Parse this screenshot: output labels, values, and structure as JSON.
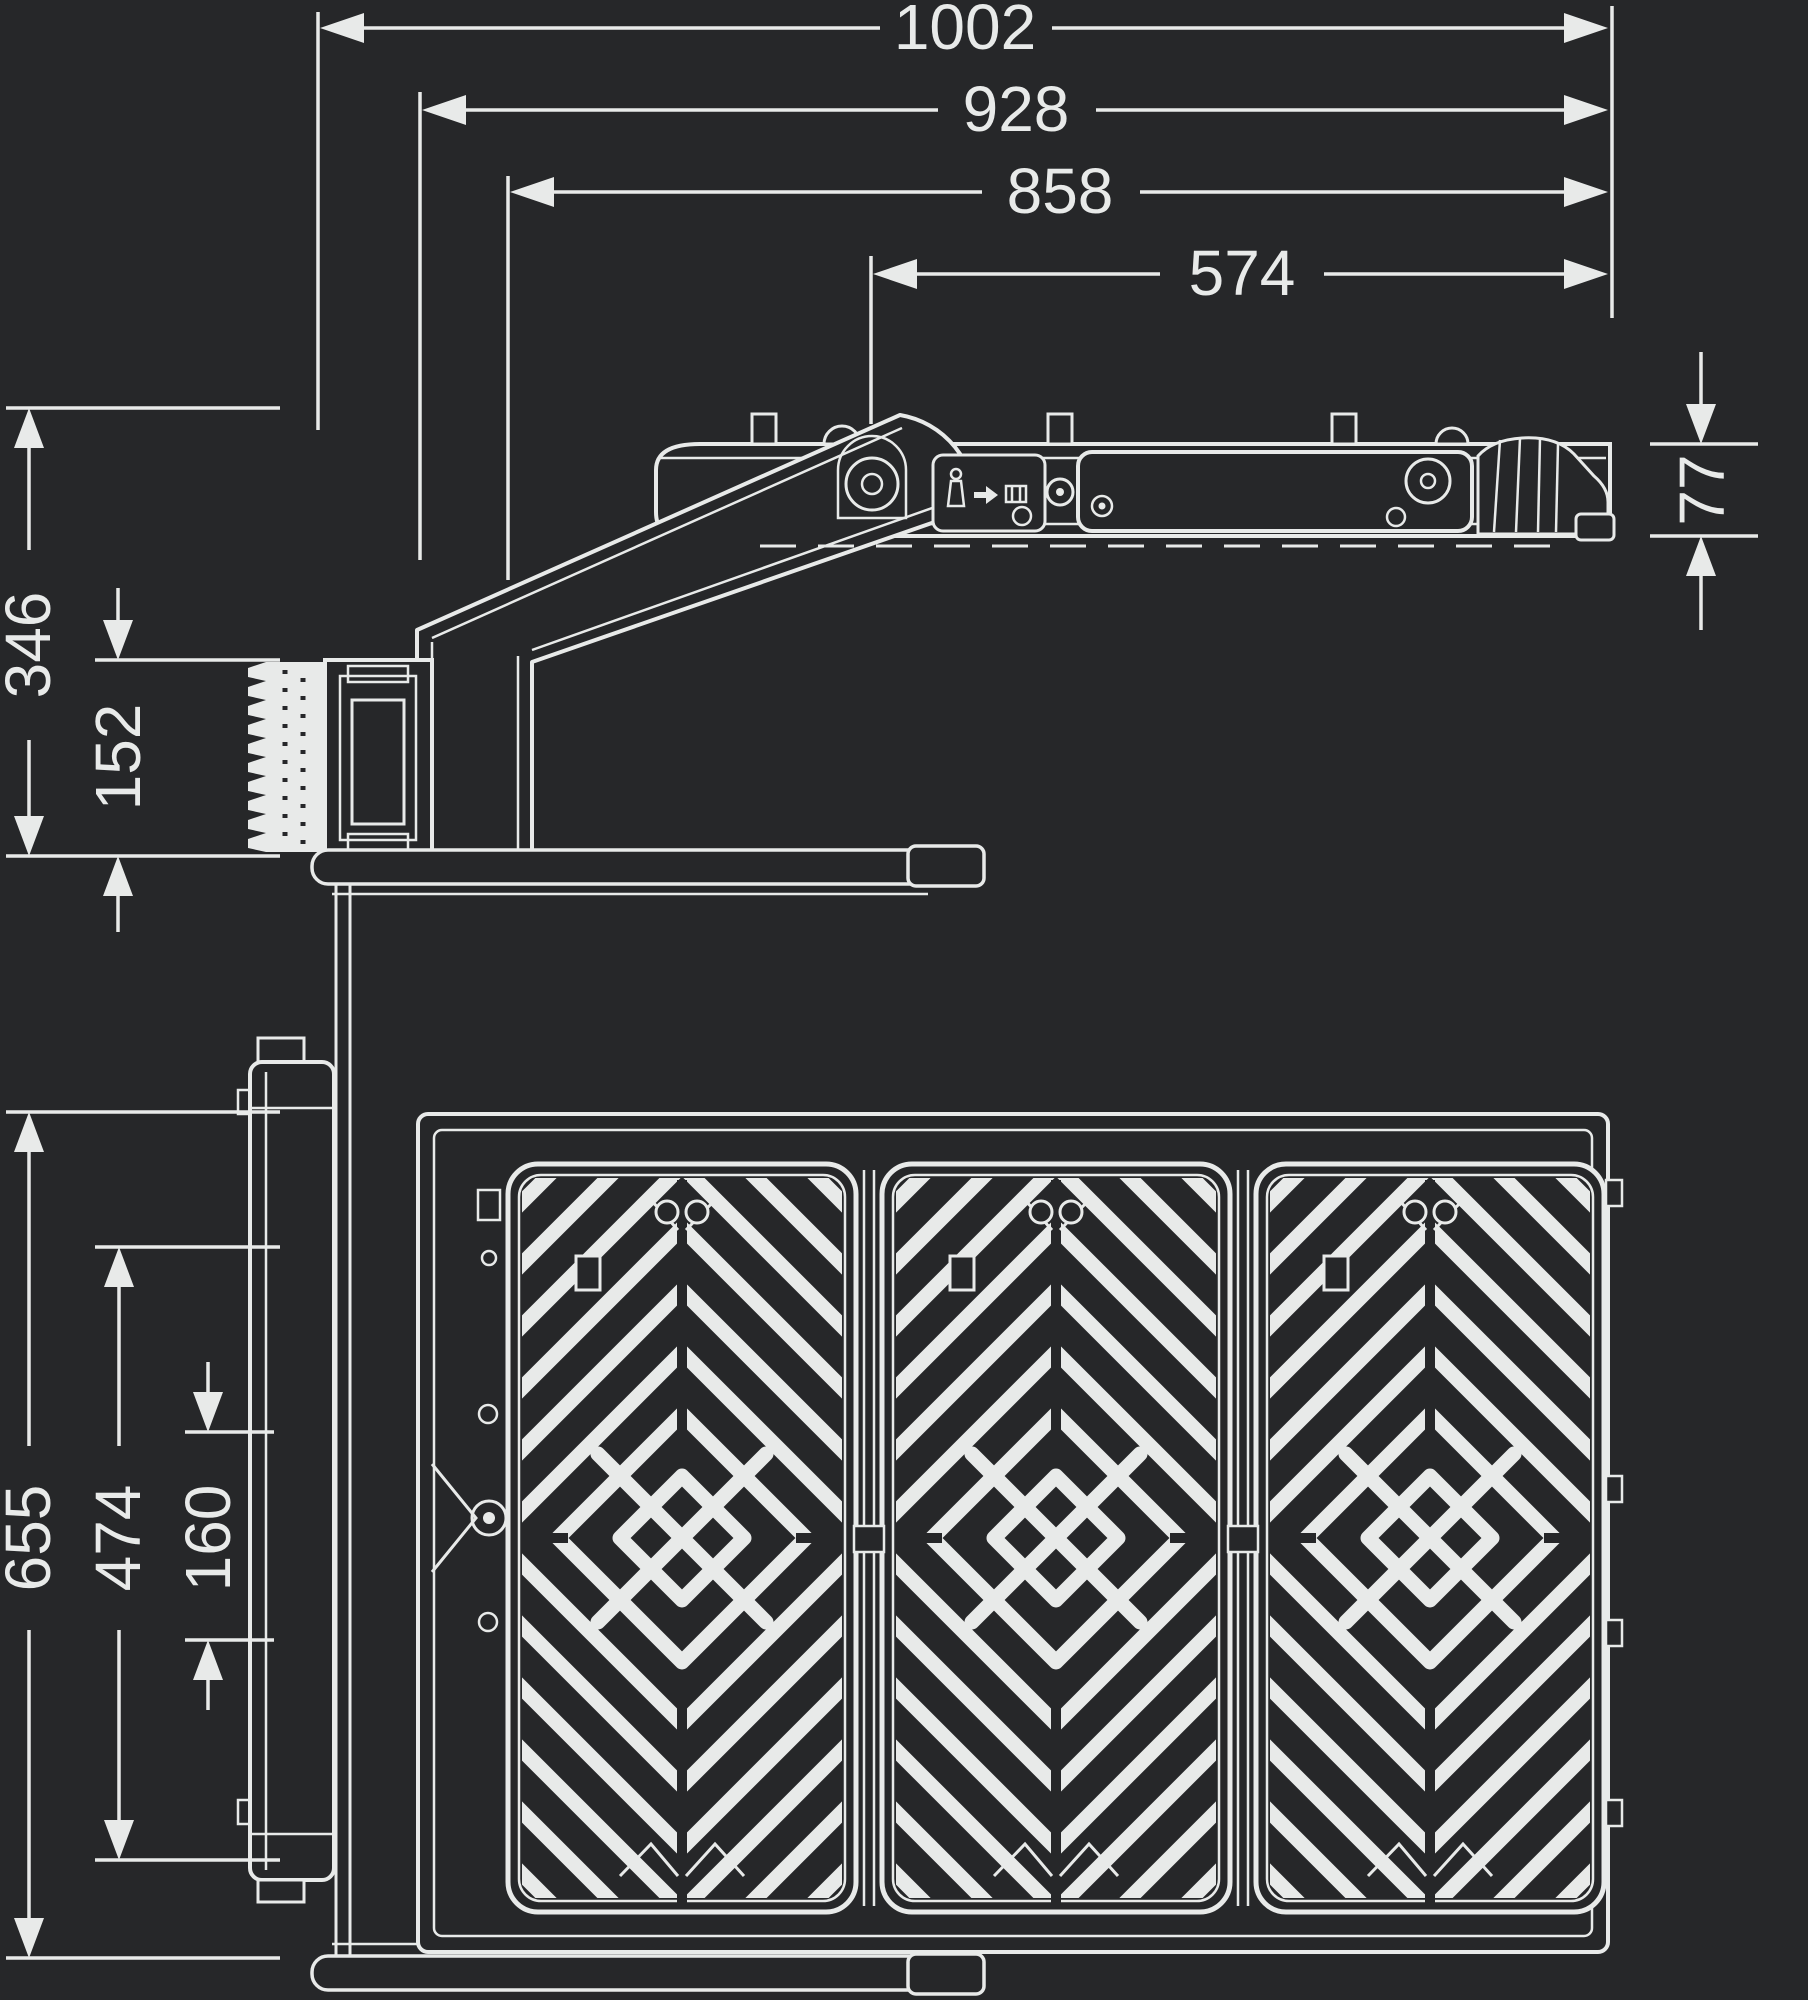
{
  "colors": {
    "background": "#262729",
    "line": "#e8eae9"
  },
  "dimensions": {
    "top": [
      {
        "id": "overall-width",
        "value": "1002"
      },
      {
        "id": "width-928",
        "value": "928"
      },
      {
        "id": "width-858",
        "value": "858"
      },
      {
        "id": "width-574",
        "value": "574"
      }
    ],
    "height_right": {
      "id": "body-height",
      "value": "77"
    },
    "side_left": [
      {
        "id": "bracket-drop",
        "value": "346"
      },
      {
        "id": "connector-height",
        "value": "152"
      }
    ],
    "bottom_left": [
      {
        "id": "housing-length",
        "value": "655"
      },
      {
        "id": "panel-area",
        "value": "474"
      },
      {
        "id": "center-module",
        "value": "160"
      }
    ]
  },
  "icons": [
    {
      "id": "hook-icon"
    },
    {
      "id": "arrow-right-icon"
    },
    {
      "id": "box-icon"
    }
  ]
}
